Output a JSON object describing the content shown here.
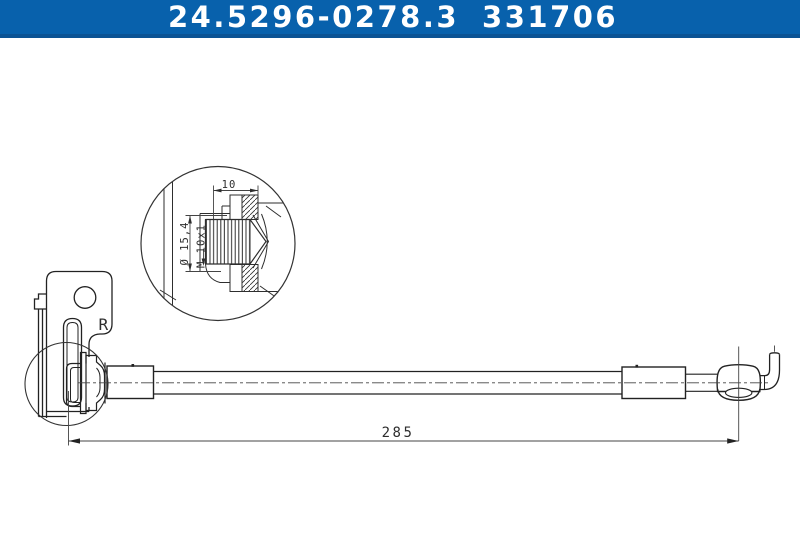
{
  "header": {
    "part_number": "24.5296-0278.3",
    "reference_number": "331706",
    "colors": {
      "band": "#0861AC",
      "band_edge": "#0B5394",
      "text": "#FFFFFF"
    }
  },
  "drawing": {
    "background": "#FFFFFF",
    "line_color": "#2E2E2E",
    "orientation_label": "R",
    "detail_view": {
      "thread_length_label": "10",
      "flange_diameter_label": "Ø 15,4",
      "thread_spec_label": "M 10x1"
    },
    "overall_length_label": "285"
  }
}
